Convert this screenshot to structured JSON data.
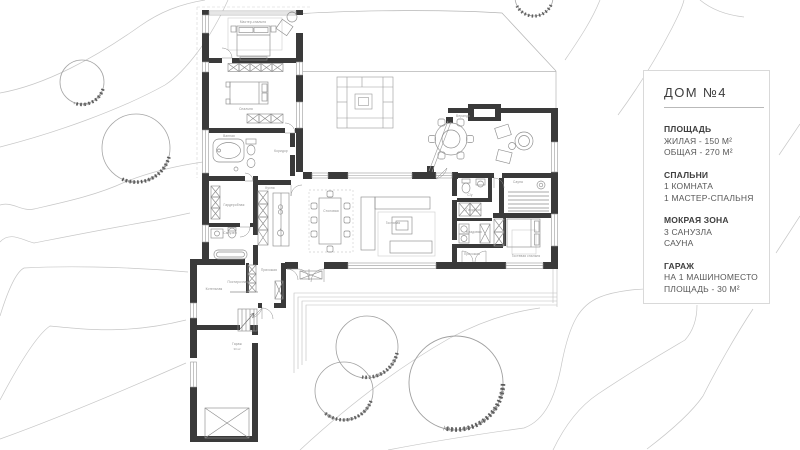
{
  "info_panel": {
    "title": "ДОМ №4",
    "sections": [
      {
        "heading": "ПЛОЩАДЬ",
        "line1": "ЖИЛАЯ - 150 М²",
        "line2": "ОБЩАЯ - 270 М²"
      },
      {
        "heading": "СПАЛЬНИ",
        "line1": "1 КОМНАТА",
        "line2": "1 МАСТЕР-СПАЛЬНЯ"
      },
      {
        "heading": "МОКРАЯ ЗОНА",
        "line1": "3 САНУЗЛА",
        "line2": "САУНА"
      },
      {
        "heading": "ГАРАЖ",
        "line1": "НА 1 МАШИНОМЕСТО",
        "line2": "ПЛОЩАДЬ - 30 М²"
      }
    ]
  },
  "plan": {
    "labels": {
      "master_bedroom": "Мастер-спальня",
      "bedroom": "Спальня",
      "bath1": "Ванная",
      "corridor": "Коридор",
      "wardrobe": "Гардеробная",
      "bath2": "Санузел",
      "kitchen": "Кухня",
      "dining": "Столовая",
      "living": "Гостиная",
      "veranda": "Веранда",
      "sauna": "Сауна",
      "bath3": "С/у",
      "wardrobe2": "Гардероб",
      "storage": "Кладовая",
      "hall_right": "Прихожая",
      "guest_bedroom": "Гостевая спальня",
      "hall": "Прихожая",
      "boiler": "Котельная",
      "laundry": "Постирочная",
      "garage": "Гараж",
      "garage_area": "30 м²"
    }
  },
  "colors": {
    "wall": "#3a3a3a",
    "contour_line": "#c7c7c7",
    "tree_outline": "#a0a0a0",
    "tree_speckle": "#4a4a4a",
    "furniture_line": "#8e8e8e",
    "panel_border": "#d9d9d9",
    "text_heading": "#3e3e3e",
    "text_body": "#585858"
  }
}
